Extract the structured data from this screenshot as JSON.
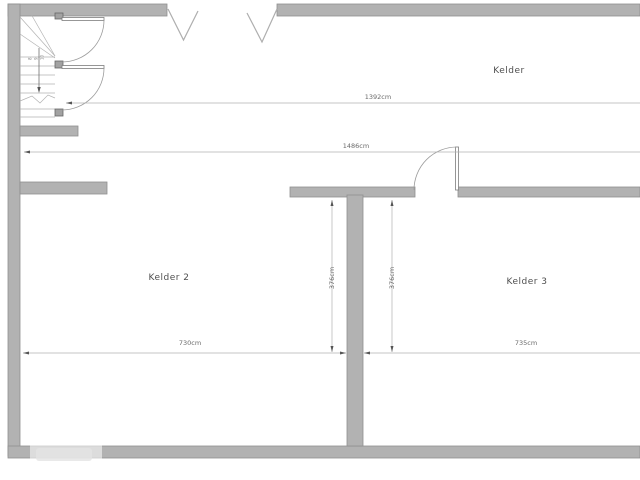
{
  "plan": {
    "room_labels": {
      "kelder": "Kelder",
      "kelder2": "Kelder 2",
      "kelder3": "Kelder 3"
    },
    "dimensions": {
      "kelder_width": "1392cm",
      "overall_width": "1486cm",
      "kelder2_width": "730cm",
      "kelder3_width": "735cm",
      "kelder2_depth": "376cm",
      "kelder3_depth": "376cm"
    },
    "stair_treads": [
      "8",
      "9",
      "10"
    ],
    "colors": {
      "wall_fill": "#b2b2b2",
      "wall_stroke": "#8f8f8f",
      "line": "#b0b0b0",
      "text": "#4f4f4f"
    }
  }
}
